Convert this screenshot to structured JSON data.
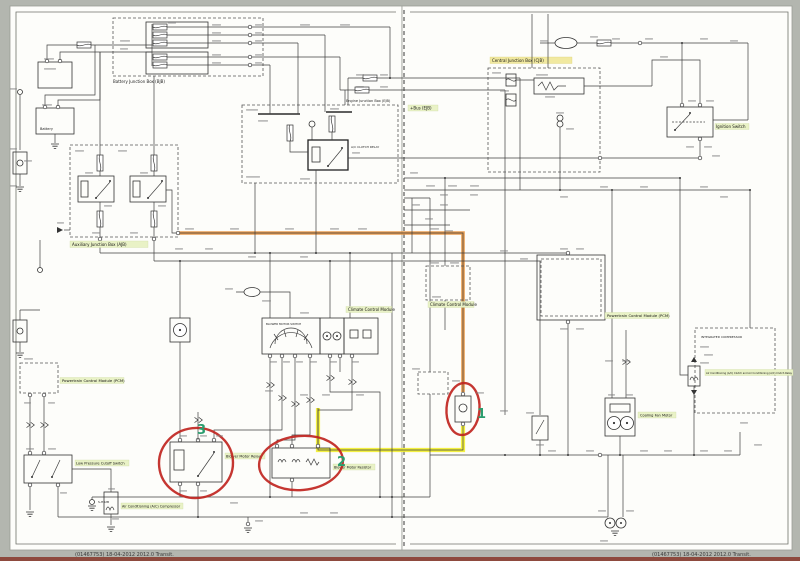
{
  "page": {
    "footer_left": "(01467753) 18-04-2012  2012.0 Transit.",
    "footer_right": "(01467753) 18-04-2012  2012.0 Transit."
  },
  "labels": {
    "battery_junction_box": "Battery Junction Box (BJB)",
    "battery": "Battery",
    "auxiliary_junction_box": "Auxiliary Junction Box (AJB)",
    "engine_junction_box": "Engine Junction Box (EJB)",
    "bus_ejb": "+Bus (EJB)",
    "ac_clutch_relay": "A/C CLUTCH RELAY",
    "central_junction_box": "Central Junction Box (CJB)",
    "ignition_switch": "Ignition Switch",
    "climate_control_module": "Climate Control Module",
    "climate_control_module_right": "Climate Control Module",
    "blower_motor_switch": "BLOWER MOTOR SWITCH",
    "pcm_left": "Powertrain Control Module (PCM)",
    "pcm_right": "Powertrain Control Module (PCM)",
    "low_pressure_cutoff_switch": "Low Pressure Cutoff Switch",
    "blower_motor_relay": "Blower Motor Relay",
    "blower_motor_resistor": "Blower Motor Resistor",
    "cooling_fan_motor": "Cooling Fan Motor",
    "integrated_compressor": "INTEGRATED COMPRESSOR",
    "ac_clutch_label": "Air Conditioning (A/C) Clutch and Air Conditioning (A/C) Clutch Relay",
    "ac_compressor": "Air Conditioning (A/C) Compressor",
    "ground_code": "S-H02B"
  },
  "annotations": {
    "markers": {
      "one": "1",
      "two": "2",
      "three": "3"
    }
  },
  "colors": {
    "highlight_wire_orange": "#E8923A",
    "highlight_wire_yellow": "#F2EE2E",
    "annotation_circle_red": "#C0251F",
    "annotation_number_green": "#2A9D6E",
    "label_highlight_green": "#E9F2C6",
    "label_highlight_yellow": "#F1E9A0",
    "wire": "#3F3F3F",
    "sheet": "#FDFDFA",
    "margin": "#B3B6AF"
  }
}
